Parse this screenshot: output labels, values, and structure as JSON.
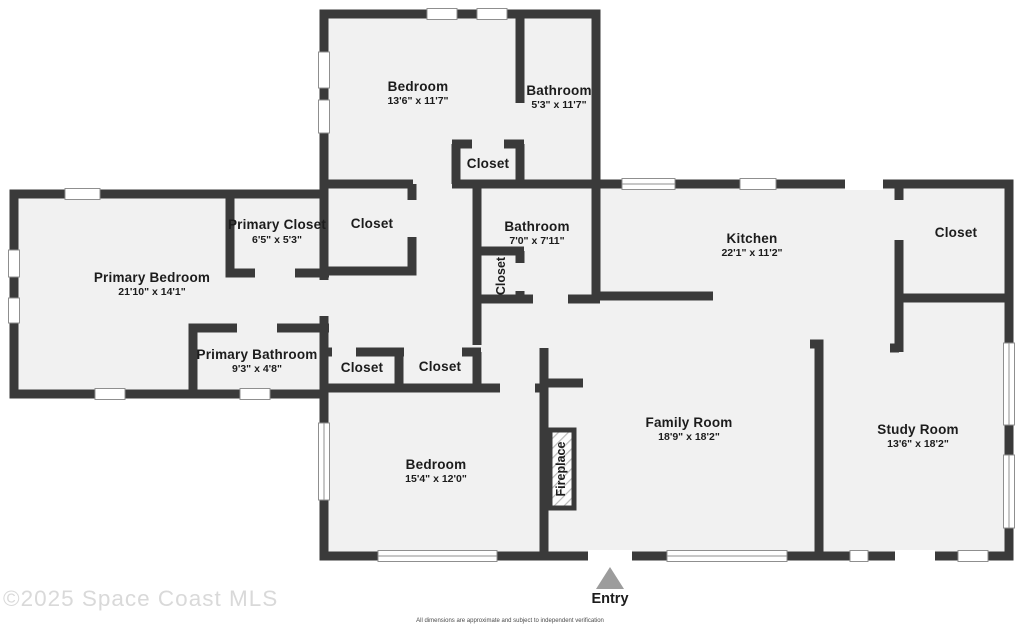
{
  "rooms": {
    "bedroom_top": {
      "name": "Bedroom",
      "dims": "13'6\" x 11'7\""
    },
    "bathroom_top": {
      "name": "Bathroom",
      "dims": "5'3\" x 11'7\""
    },
    "closet_top": {
      "label": "Closet"
    },
    "primary_closet": {
      "name": "Primary Closet",
      "dims": "6'5\" x 5'3\""
    },
    "closet_mid": {
      "label": "Closet"
    },
    "bathroom_mid": {
      "name": "Bathroom",
      "dims": "7'0\" x 7'11\""
    },
    "bathroom_closet": {
      "label": "Closet"
    },
    "kitchen": {
      "name": "Kitchen",
      "dims": "22'1\" x 11'2\""
    },
    "closet_right": {
      "label": "Closet"
    },
    "primary_bedroom": {
      "name": "Primary Bedroom",
      "dims": "21'10\" x 14'1\""
    },
    "primary_bathroom": {
      "name": "Primary Bathroom",
      "dims": "9'3\" x 4'8\""
    },
    "closet_hall_left": {
      "label": "Closet"
    },
    "closet_hall_right": {
      "label": "Closet"
    },
    "bedroom_lower": {
      "name": "Bedroom",
      "dims": "15'4\" x 12'0\""
    },
    "family_room": {
      "name": "Family Room",
      "dims": "18'9\" x 18'2\""
    },
    "study_room": {
      "name": "Study Room",
      "dims": "13'6\" x 18'2\""
    },
    "fireplace": {
      "label": "Fireplace"
    },
    "entry": {
      "label": "Entry"
    }
  },
  "watermark": "©2025 Space Coast MLS",
  "disclaimer": "All dimensions are approximate and subject to independent verification",
  "colors": {
    "wall": "#3a3a3a",
    "floor": "#f1f1f1",
    "window_frame": "#8f8f8f",
    "entry_arrow": "#9c9c9c",
    "watermark": "#d9d9d9",
    "label": "#1c1c1c",
    "disclaimer": "#4a4a4a"
  }
}
